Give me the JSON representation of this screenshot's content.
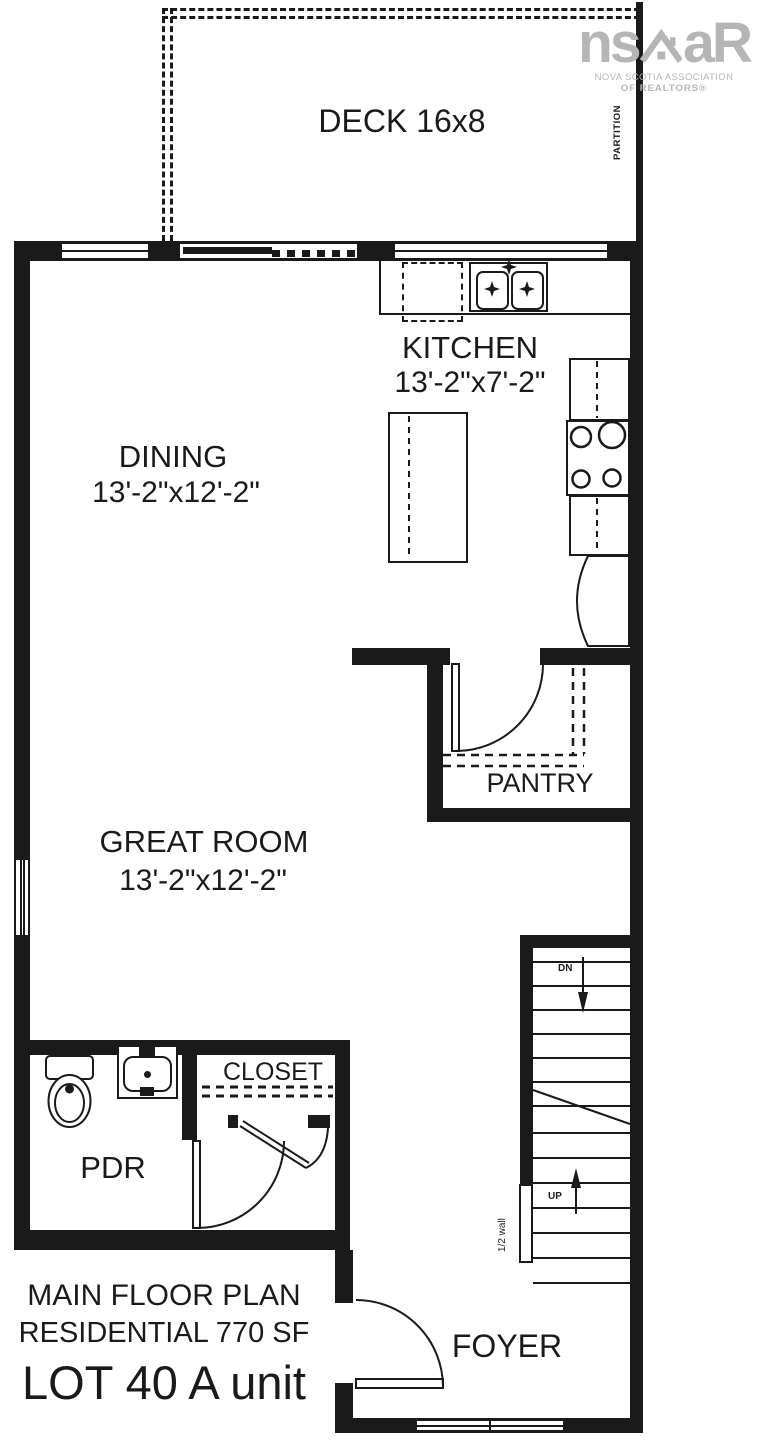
{
  "plan": {
    "rooms": {
      "deck": {
        "label": "DECK 16x8"
      },
      "kitchen": {
        "label": "KITCHEN",
        "dims": "13'-2\"x7'-2\""
      },
      "dining": {
        "label": "DINING",
        "dims": "13'-2\"x12'-2\""
      },
      "great_room": {
        "label": "GREAT ROOM",
        "dims": "13'-2\"x12'-2\""
      },
      "pantry": {
        "label": "PANTRY"
      },
      "closet": {
        "label": "CLOSET"
      },
      "pdr": {
        "label": "PDR"
      },
      "foyer": {
        "label": "FOYER"
      }
    },
    "annotations": {
      "partition": "PARTITION",
      "stairs_down": "DN",
      "stairs_up": "UP",
      "half_wall": "1/2 wall"
    },
    "title_block": {
      "line1": "MAIN FLOOR PLAN",
      "line2": "RESIDENTIAL 770 SF",
      "line3": "LOT 40 A unit"
    }
  },
  "logo": {
    "word_left": "ns",
    "word_right": "aR",
    "tagline1": "NOVA SCOTIA ASSOCIATION",
    "tagline2": "OF REALTORS®"
  },
  "colors": {
    "ink": "#1a1a1a",
    "logo_gray": "#b5b5b5"
  }
}
